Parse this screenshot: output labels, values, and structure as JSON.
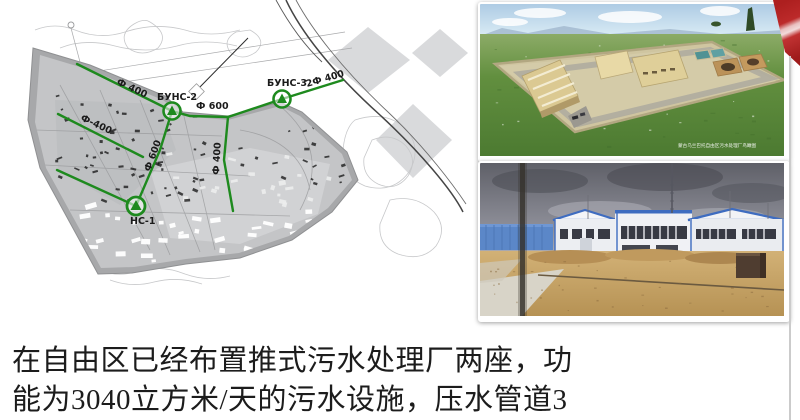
{
  "slide": {
    "body_text_line1": "在自由区已经布置推式污水处理厂两座，功",
    "body_text_line2": "能为3040立方米/天的污水设施，压水管道3"
  },
  "map": {
    "labels": {
      "pipe_f400_top": "Ф 400",
      "station_buns2": "БУНС-2",
      "pipe_f600_main": "Ф 600",
      "station_buns3": "БУНС-3",
      "pipe_2f400": "2Ф 400",
      "pipe_f400_left": "Ф-400",
      "pipe_f600_vertical": "Ф 600",
      "pipe_f400_vertical": "Ф 400",
      "station_ns1": "НС-1"
    }
  },
  "photos": {
    "render_caption": "蒙古乌兰巴托自由区污水处理厂鸟瞰图"
  },
  "colors": {
    "pipeline_green": "#1e8a1e",
    "ribbon_red": "#b42020"
  }
}
